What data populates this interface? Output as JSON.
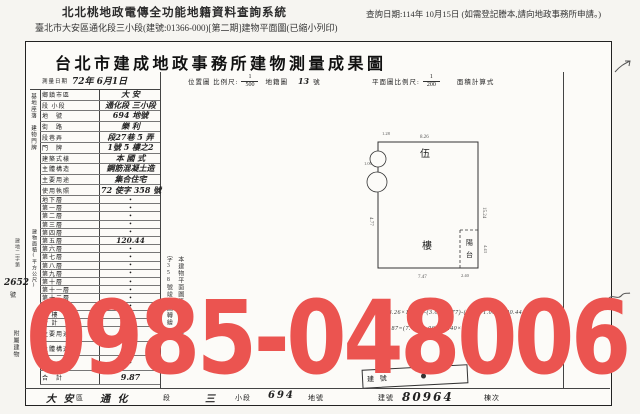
{
  "header": {
    "system_title": "北北桃地政電傳全功能地籍資料查詢系統",
    "query_date": "查詢日期:114年 10月15日 (如需登記謄本,請向地政事務所申請。)",
    "subtitle": "臺北市大安區通化段三小段(建號:01366-000)[第二期]建物平面圖(已縮小列印)"
  },
  "document": {
    "title": "台北市建成地政事務所建物測量成果圖",
    "survey_date_label": "測量日期",
    "survey_date_value": "72年 6月1日",
    "location_map_label": "位置圖 比例尺:",
    "location_scale_num": "1",
    "location_scale_den": "500",
    "cadastre_label": "地籍圖",
    "cadastre_value": "13",
    "cadastre_suffix": "號",
    "plan_scale_label": "平面圖比例尺:",
    "plan_scale_num": "1",
    "plan_scale_den": "200",
    "area_calc_label": "面積計算式"
  },
  "left_table": {
    "group_site": "基地座落",
    "group_address": "建物門牌",
    "group_area": "建物面積(平方公尺)",
    "info_rows": [
      {
        "label": "鄉鎮市區",
        "value": "大 安",
        "hw": true
      },
      {
        "label": "段 小段",
        "value": "通化段 三小段",
        "hw": true
      },
      {
        "label": "地　號",
        "value": "694 地號",
        "hw": true
      },
      {
        "label": "街　路",
        "value": "樂 利",
        "hw": true
      },
      {
        "label": "段巷弄",
        "value": "段27巷 5 弄",
        "hw": true
      },
      {
        "label": "門　牌",
        "value": "1號 5 樓之2",
        "hw": true
      },
      {
        "label": "建築式樣",
        "value": "本 國 式",
        "hw": true
      },
      {
        "label": "主體構造",
        "value": "鋼筋混凝土造",
        "hw": true
      },
      {
        "label": "主要用途",
        "value": "集合住宅",
        "hw": true
      },
      {
        "label": "使用執照",
        "value": "72 使字 358 號",
        "hw": true
      }
    ],
    "floor_rows": [
      {
        "label": "地下層",
        "value": "•"
      },
      {
        "label": "第一層",
        "value": "•"
      },
      {
        "label": "第二層",
        "value": "•"
      },
      {
        "label": "第三層",
        "value": "•"
      },
      {
        "label": "第四層",
        "value": "•"
      },
      {
        "label": "第五層",
        "value": "120.44",
        "hw": true
      },
      {
        "label": "第六層",
        "value": "•"
      },
      {
        "label": "第七層",
        "value": "•"
      },
      {
        "label": "第八層",
        "value": "•"
      },
      {
        "label": "第九層",
        "value": "•"
      },
      {
        "label": "第十層",
        "value": "•"
      },
      {
        "label": "第十一層",
        "value": "•"
      },
      {
        "label": "第十二層",
        "value": "•"
      },
      {
        "label": "第十三層",
        "value": "•"
      },
      {
        "label": "騎 樓",
        "value": "•"
      },
      {
        "label": "合 計",
        "value": "•"
      }
    ],
    "annex_label": "附屬建物",
    "annex_rows": [
      {
        "label": "主要用途",
        "value": "•"
      },
      {
        "label": "主體構造",
        "value": "•"
      },
      {
        "label": "",
        "value": "•"
      },
      {
        "label": "合　計",
        "value": "9.87",
        "hw": true
      }
    ],
    "receipt_prefix": "建地二字第",
    "receipt_value": "2652",
    "receipt_suffix": "號"
  },
  "plan": {
    "floor_char_top": "伍",
    "floor_char_bottom": "樓",
    "balcony_char_top": "陽",
    "balcony_char_bottom": "台",
    "dims": {
      "top": "8.26",
      "right": "15.24",
      "bottom": "7.47",
      "left": "4.77",
      "balcony_bottom": "2.40",
      "balcony_right": "4.43",
      "notch_a": "1.28",
      "notch_b": "1.00"
    }
  },
  "notes": {
    "vertical_line1": "本建物平面圖係",
    "vertical_line2": "依72使字358號竣工圖轉繪",
    "calc_line1": "(8.26×15.24)-(3.01×4.77)-(1.28×1.00)=120.44",
    "calc_line2": "9.87=(7.47×1.00)+(2.40×1.00)"
  },
  "stamp_label": "建 號",
  "bottom_bar": [
    {
      "text": "大 安",
      "hw": true
    },
    {
      "text": "區"
    },
    {
      "text": "通 化",
      "hw": true
    },
    {
      "text": "段"
    },
    {
      "text": "三",
      "hw": true
    },
    {
      "text": "小段"
    },
    {
      "text": "694",
      "hw": true
    },
    {
      "text": "地號"
    },
    {
      "text": "建號"
    },
    {
      "text": "80964",
      "hw": true,
      "big": true
    },
    {
      "text": "棟次"
    }
  ],
  "watermark": "0985-048006",
  "colors": {
    "watermark": "#eb5450",
    "paper": "#fcfbf8"
  }
}
